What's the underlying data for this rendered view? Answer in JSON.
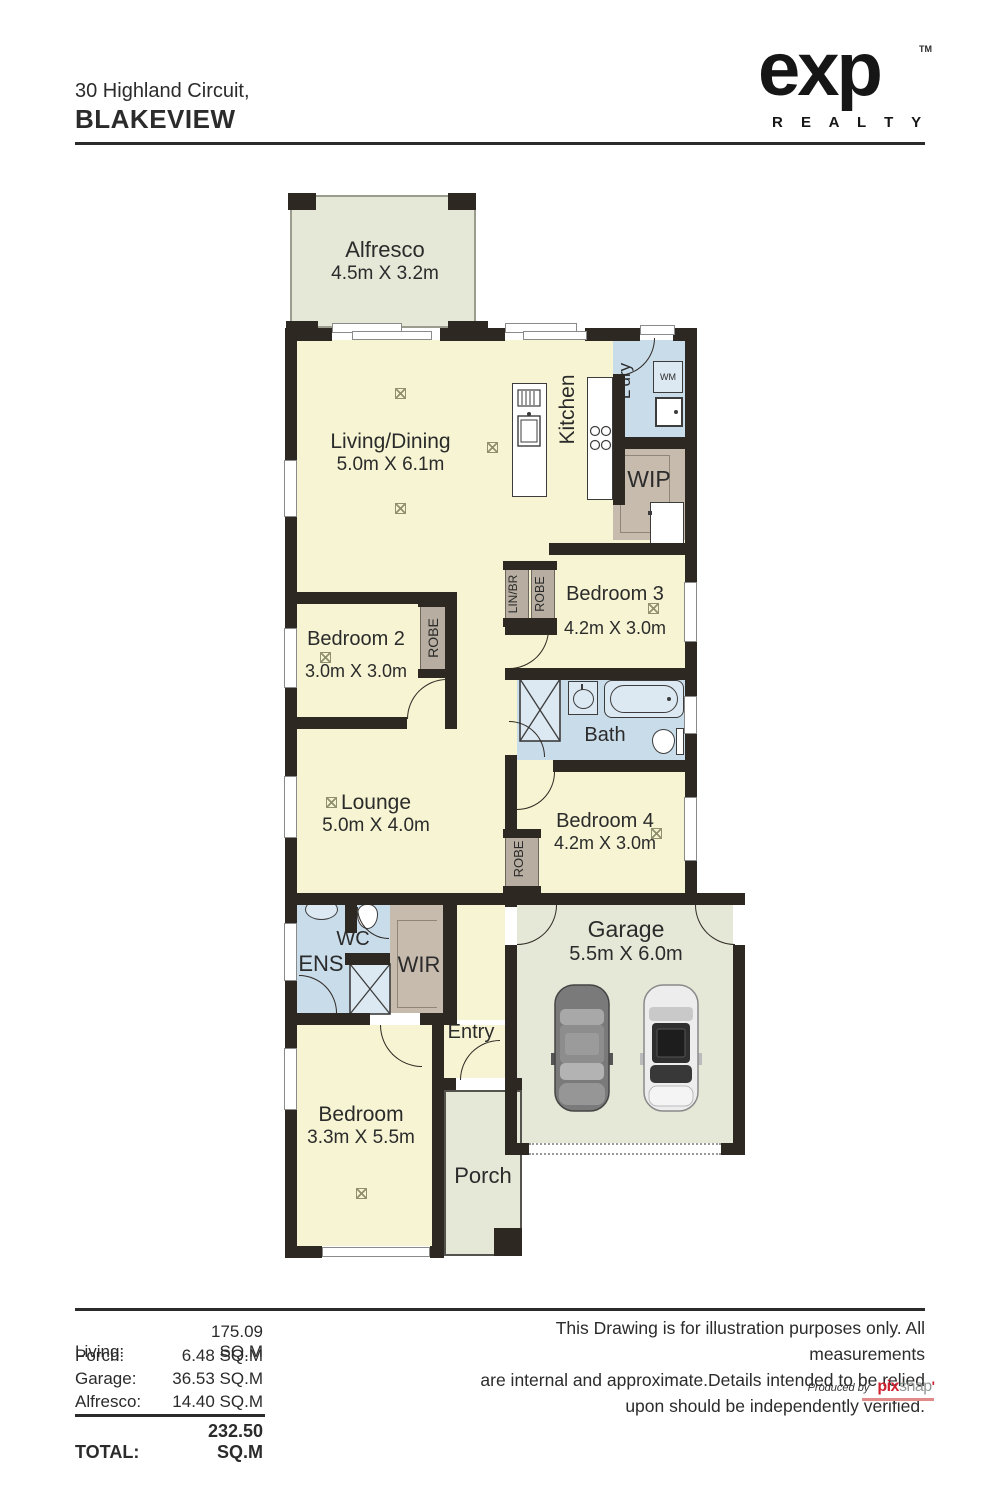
{
  "header": {
    "address1": "30 Highland Circuit,",
    "address2": "BLAKEVIEW"
  },
  "logo": {
    "word": "exp",
    "tm": "TM",
    "sub": "R E A L T Y"
  },
  "rooms": {
    "alfresco": {
      "name": "Alfresco",
      "dims": "4.5m X 3.2m"
    },
    "living": {
      "name": "Living/Dining",
      "dims": "5.0m X 6.1m"
    },
    "kitchen": "Kitchen",
    "ldry": "L'dry",
    "wm": "WM",
    "wip": "WIP",
    "bedroom3": {
      "name": "Bedroom 3",
      "dims": "4.2m X 3.0m"
    },
    "linbr": "LIN/BR",
    "robe": "ROBE",
    "bedroom2": {
      "name": "Bedroom 2",
      "dims": "3.0m X 3.0m"
    },
    "bath": "Bath",
    "lounge": {
      "name": "Lounge",
      "dims": "5.0m X 4.0m"
    },
    "bedroom4": {
      "name": "Bedroom 4",
      "dims": "4.2m X 3.0m"
    },
    "wc": "WC",
    "ens": "ENS",
    "wir": "WIR",
    "entry": "Entry",
    "garage": {
      "name": "Garage",
      "dims": "5.5m X 6.0m"
    },
    "bedroom_front": {
      "name": "Bedroom",
      "dims": "3.3m X 5.5m"
    },
    "porch": "Porch"
  },
  "areas": {
    "rows": [
      {
        "label": "Living:",
        "value": "175.09 SQ.M"
      },
      {
        "label": "Porch:",
        "value": "6.48 SQ.M"
      },
      {
        "label": "Garage:",
        "value": "36.53 SQ.M"
      },
      {
        "label": "Alfresco:",
        "value": "14.40 SQ.M"
      }
    ],
    "total": {
      "label": "TOTAL:",
      "value": "232.50 SQ.M"
    }
  },
  "disclaimer": {
    "l1": "This Drawing is for illustration purposes only. All measurements",
    "l2": "are internal and approximate.Details intended to be relied",
    "l3": "upon should be independently verified."
  },
  "credit": {
    "prefix": "Produced by",
    "pix": "pix",
    "snap": "snap",
    "apos": "'"
  },
  "colors": {
    "wall": "#2e2823",
    "floor": "#f6f4d2",
    "wet": "#c9dcea",
    "storage": "#c7bbae",
    "outdoor": "#e5e7d7",
    "brand_red": "#cf2030"
  }
}
